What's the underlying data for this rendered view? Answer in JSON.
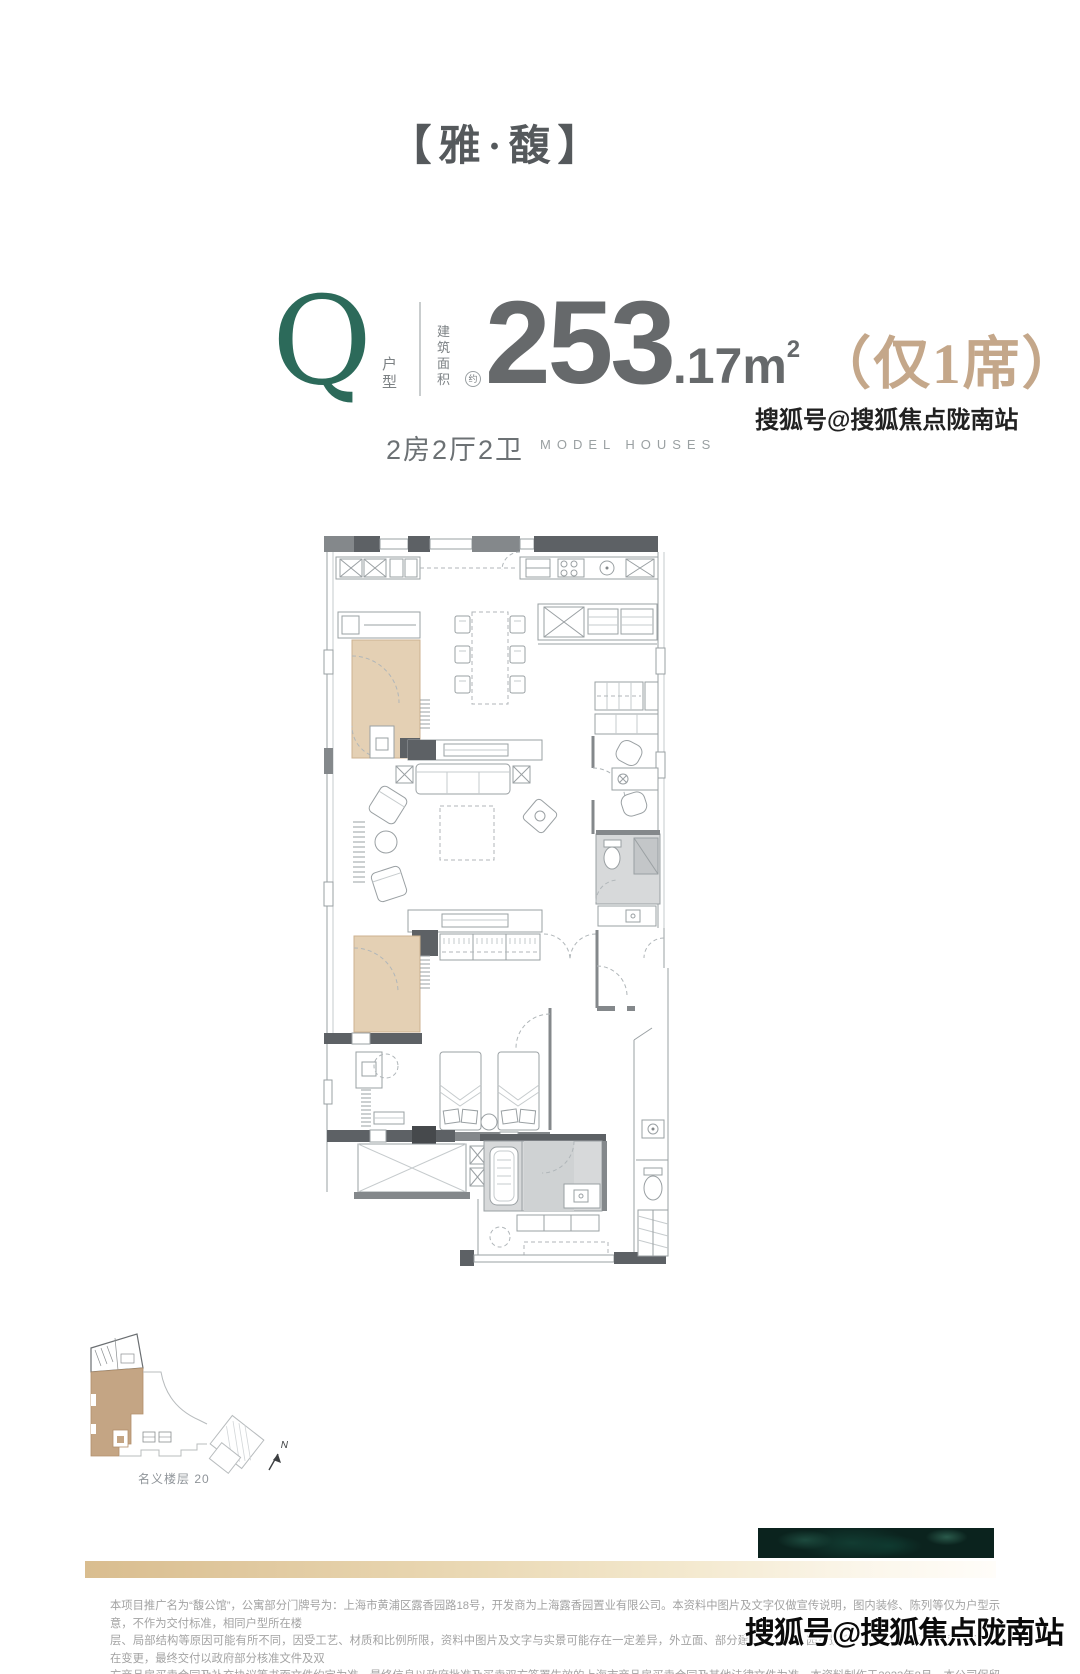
{
  "header": {
    "title": "【雅·馥】"
  },
  "spec": {
    "unit_letter": "Q",
    "unit_type_label": "户型",
    "area_label_line1": "建筑",
    "area_label_line2": "面积",
    "area_approx_badge": "约",
    "area_int": "253",
    "area_frac": ".17m",
    "area_sup": "2",
    "exclusive_badge": "（仅1席）",
    "layout_config": "2房2厅2卫",
    "model_houses": "MODEL HOUSES"
  },
  "site_plan": {
    "floor_label": "名义楼层 20",
    "north_label": "N"
  },
  "footer": {
    "disclaimer_lines": [
      "本项目推广名为“馥公馆”，公寓部分门牌号为：上海市黄浦区露香园路18号，开发商为上海露香园置业有限公司。本资料中图片及文字仅做宣传说明，图内装修、陈列等仅为户型示意，不作为交付标准，相同户型所在楼",
      "层、局部结构等原因可能有所不同，因受工艺、材质和比例所限，资料中图片及文字与实景可能存在一定差异，外立面、部分建筑、设施、园林景观、周边环境等信息后期可能存在变更，最终交付以政府部分核准文件及双",
      "方商品房买卖合同及补充协议等书面文件约定为准，最终信息以政府批准及买卖双方签署生效的上海市商品房买卖合同及其他法律文件为准。本资料制作于2023年8月，本公司保留以上内容的解释权。"
    ]
  },
  "watermark": {
    "text": "搜狐号@搜狐焦点陇南站"
  },
  "colors": {
    "brand_green": "#2c6a5a",
    "gold": "#c4a78a",
    "number_gray": "#66696b",
    "title_gray": "#55595c",
    "plan_beige": "#e4d0b4",
    "marble_green": "#0b231e"
  }
}
